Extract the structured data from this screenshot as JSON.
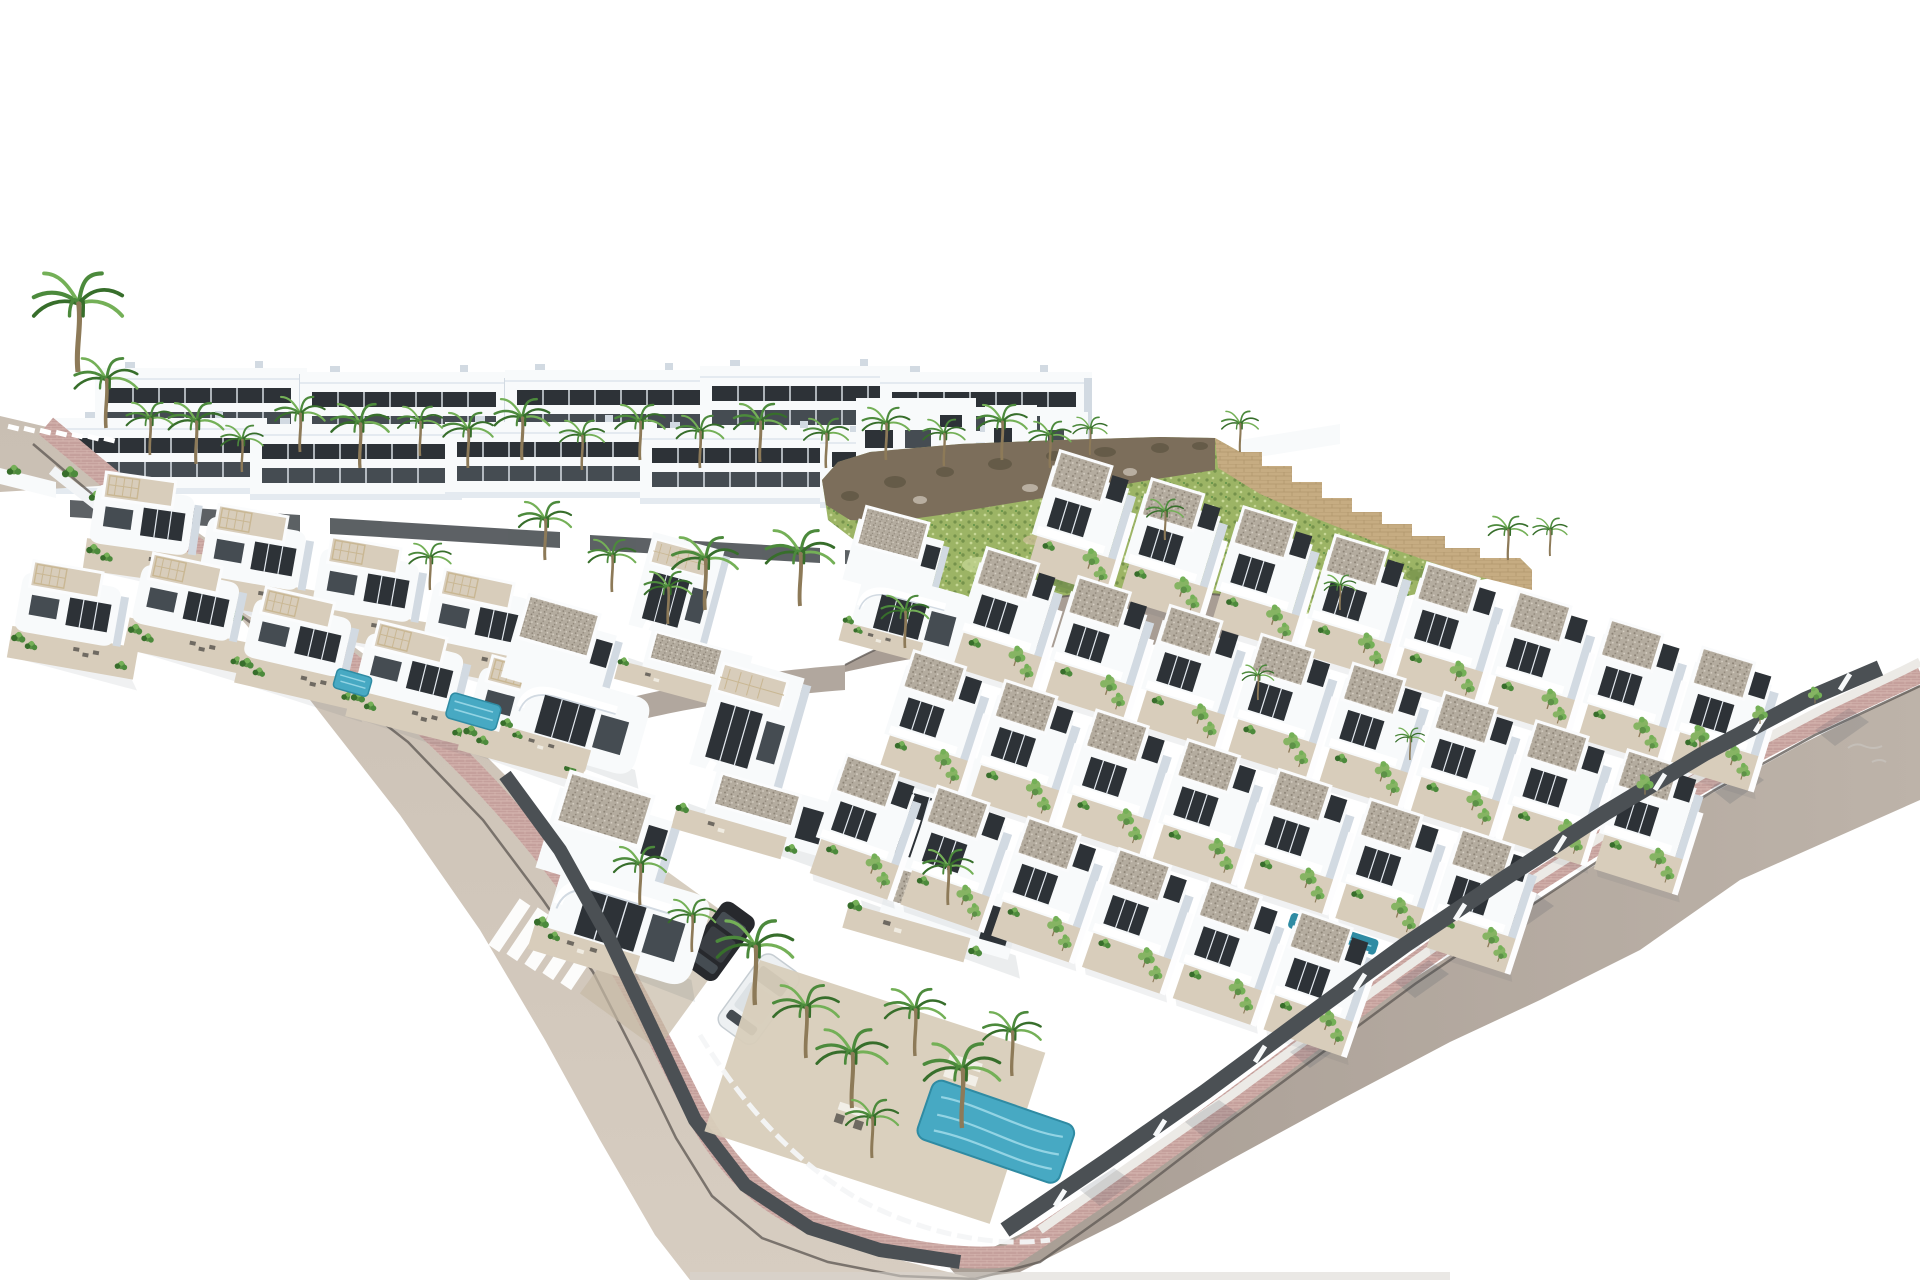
{
  "scene": {
    "type": "architectural-aerial-3d-render",
    "subject": "Aerial render of a modern white villa and townhouse development on a hillside, with palm trees, private pools, curved streets with pink brick sidewalks, and a green slope with rocky ridge",
    "background_color": "#ffffff",
    "text_visible": "none"
  },
  "palette": {
    "background": "#ffffff",
    "wall_white": "#f8fafb",
    "wall_shade": "#e4eaf0",
    "wall_shade2": "#d2dae2",
    "deep_shade": "#bac4cd",
    "glass_dark": "#2d3237",
    "glass_mid": "#454c52",
    "roof_gravel": "#b4ac9f",
    "gravel_dot": "#8b8275",
    "gravel_dot_light": "#d8d1c5",
    "terrace": "#d8cdbb",
    "terrace_dark": "#c6b9a5",
    "road_beige": "#c9bfb3",
    "road_beige_light": "#d7cdc1",
    "road_gray": "#a89d94",
    "road_gray_light": "#bdb3a9",
    "sidewalk_pink": "#c5a09c",
    "sidewalk_pink_light": "#d8b8b2",
    "curb_dark": "#635d57",
    "concrete_white": "#eceae6",
    "pool_teal": "#47a9c3",
    "pool_light": "#93d4e4",
    "pool_deep": "#2f8ba3",
    "hill_green": "#9cb465",
    "hill_green_dark": "#75924b",
    "hill_green_light": "#c6d795",
    "tan_patch": "#cdbf9a",
    "rock_brown": "#7c6e5b",
    "rock_dark": "#5a523f",
    "stone_tan": "#c6ac82",
    "stone_dark": "#a78d63",
    "palm_green": "#4c8a3c",
    "palm_dark": "#376e2b",
    "palm_light": "#74b057",
    "shrub_green": "#5d9147",
    "garden_green": "#86b463",
    "trunk_brown": "#8d7a58",
    "fence_dark": "#4b5054",
    "wall_gray": "#939aa0",
    "car_dark": "#27292d",
    "car_white": "#edf0f2",
    "shadow_tint": "#3c4a58"
  },
  "inventory": {
    "apartment_blocks_back_rows": 10,
    "hilltop_villas": 3,
    "left_cluster_villas": 9,
    "center_foreground_villas": 6,
    "townhouse_rows": 4,
    "townhouse_units": 29,
    "palm_trees": 44,
    "swimming_pools": 4,
    "parked_cars": 2,
    "pedestrian_crossings": 2,
    "streets": 3
  }
}
